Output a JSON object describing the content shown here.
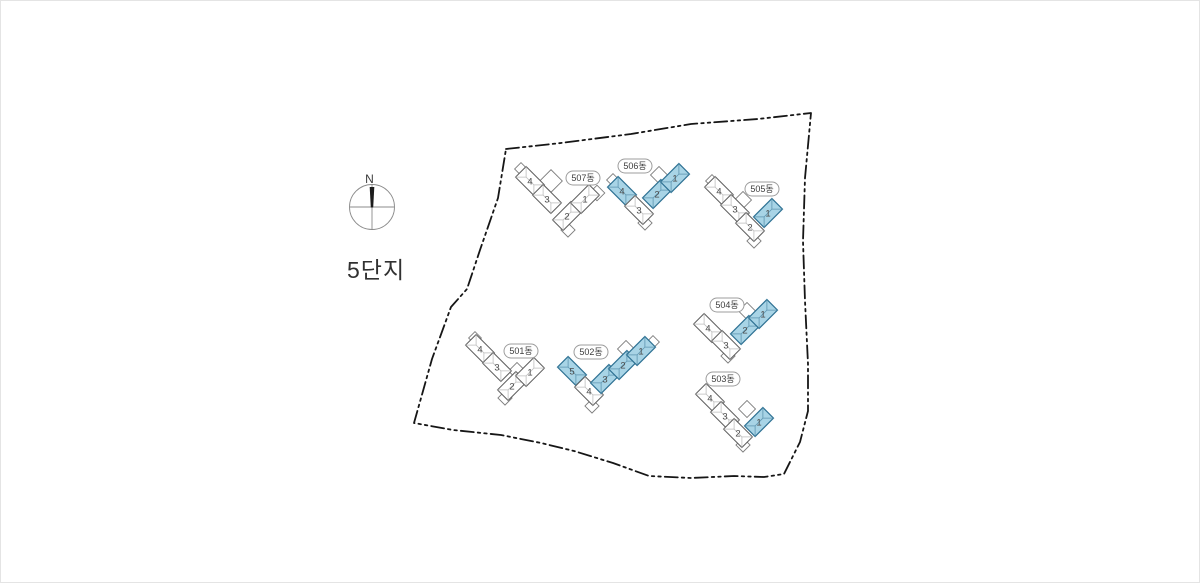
{
  "title": "5단지",
  "compass": {
    "label": "N"
  },
  "colors": {
    "selected_fill": "#A8D4E6",
    "selected_stroke": "#2E7193",
    "selected_roof_line": "#5E95B0",
    "unit_fill": "#FFFFFF",
    "unit_stroke": "#5F5F5F",
    "roof_line": "#BCBCBC",
    "boundary": "#161616",
    "title_color": "#313131"
  },
  "boundary": [
    [
      505,
      148
    ],
    [
      560,
      142
    ],
    [
      630,
      133
    ],
    [
      690,
      123
    ],
    [
      757,
      118
    ],
    [
      810,
      112
    ],
    [
      804,
      177
    ],
    [
      802,
      240
    ],
    [
      804,
      300
    ],
    [
      807,
      363
    ],
    [
      807,
      410
    ],
    [
      799,
      441
    ],
    [
      783,
      473
    ],
    [
      763,
      476
    ],
    [
      733,
      475
    ],
    [
      690,
      477
    ],
    [
      648,
      475
    ],
    [
      612,
      462
    ],
    [
      573,
      450
    ],
    [
      540,
      442
    ],
    [
      500,
      434
    ],
    [
      452,
      429
    ],
    [
      413,
      422
    ],
    [
      431,
      358
    ],
    [
      450,
      306
    ],
    [
      466,
      288
    ],
    [
      479,
      249
    ],
    [
      497,
      197
    ]
  ],
  "buildings": [
    {
      "id": "501",
      "name": "501동",
      "label": {
        "x": 520,
        "y": 350
      },
      "units": [
        {
          "no": "4",
          "cx": 479,
          "cy": 348,
          "angle": 45,
          "selected": false
        },
        {
          "no": "3",
          "cx": 496,
          "cy": 366,
          "angle": 45,
          "selected": false
        },
        {
          "no": "2",
          "cx": 511,
          "cy": 385,
          "angle": -45,
          "selected": false
        },
        {
          "no": "1",
          "cx": 529,
          "cy": 371,
          "angle": -45,
          "selected": false
        }
      ],
      "bumps": [
        [
          516,
          370,
          12
        ],
        [
          504,
          397,
          10
        ],
        [
          474,
          337,
          9
        ]
      ]
    },
    {
      "id": "502",
      "name": "502동",
      "label": {
        "x": 590,
        "y": 351
      },
      "units": [
        {
          "no": "5",
          "cx": 571,
          "cy": 370,
          "angle": 45,
          "selected": true
        },
        {
          "no": "4",
          "cx": 588,
          "cy": 390,
          "angle": 45,
          "selected": false
        },
        {
          "no": "3",
          "cx": 604,
          "cy": 378,
          "angle": -45,
          "selected": true
        },
        {
          "no": "2",
          "cx": 622,
          "cy": 364,
          "angle": -45,
          "selected": true
        },
        {
          "no": "1",
          "cx": 640,
          "cy": 350,
          "angle": -45,
          "selected": true
        }
      ],
      "bumps": [
        [
          625,
          348,
          12
        ],
        [
          591,
          405,
          10
        ],
        [
          652,
          341,
          9
        ]
      ]
    },
    {
      "id": "503",
      "name": "503동",
      "label": {
        "x": 722,
        "y": 378
      },
      "units": [
        {
          "no": "4",
          "cx": 709,
          "cy": 397,
          "angle": 45,
          "selected": false
        },
        {
          "no": "3",
          "cx": 724,
          "cy": 415,
          "angle": 45,
          "selected": false
        },
        {
          "no": "2",
          "cx": 737,
          "cy": 432,
          "angle": 45,
          "selected": false
        },
        {
          "no": "1",
          "cx": 758,
          "cy": 421,
          "angle": -45,
          "selected": true
        }
      ],
      "bumps": [
        [
          746,
          408,
          12
        ],
        [
          742,
          444,
          10
        ]
      ]
    },
    {
      "id": "504",
      "name": "504동",
      "label": {
        "x": 726,
        "y": 304
      },
      "units": [
        {
          "no": "4",
          "cx": 707,
          "cy": 327,
          "angle": 45,
          "selected": false
        },
        {
          "no": "3",
          "cx": 725,
          "cy": 344,
          "angle": 45,
          "selected": false
        },
        {
          "no": "2",
          "cx": 744,
          "cy": 329,
          "angle": -45,
          "selected": true
        },
        {
          "no": "1",
          "cx": 762,
          "cy": 313,
          "angle": -45,
          "selected": true
        }
      ],
      "bumps": [
        [
          746,
          310,
          12
        ],
        [
          727,
          355,
          10
        ]
      ]
    },
    {
      "id": "505",
      "name": "505동",
      "label": {
        "x": 761,
        "y": 188
      },
      "units": [
        {
          "no": "4",
          "cx": 718,
          "cy": 190,
          "angle": 45,
          "selected": false
        },
        {
          "no": "3",
          "cx": 734,
          "cy": 208,
          "angle": 45,
          "selected": false
        },
        {
          "no": "2",
          "cx": 749,
          "cy": 226,
          "angle": 45,
          "selected": false
        },
        {
          "no": "1",
          "cx": 767,
          "cy": 212,
          "angle": -45,
          "selected": true
        }
      ],
      "bumps": [
        [
          742,
          199,
          12
        ],
        [
          753,
          240,
          10
        ],
        [
          711,
          180,
          9
        ]
      ]
    },
    {
      "id": "506",
      "name": "506동",
      "label": {
        "x": 634,
        "y": 165
      },
      "units": [
        {
          "no": "4",
          "cx": 621,
          "cy": 190,
          "angle": 45,
          "selected": true
        },
        {
          "no": "3",
          "cx": 638,
          "cy": 209,
          "angle": 45,
          "selected": false
        },
        {
          "no": "2",
          "cx": 656,
          "cy": 193,
          "angle": -45,
          "selected": true
        },
        {
          "no": "1",
          "cx": 674,
          "cy": 177,
          "angle": -45,
          "selected": true
        }
      ],
      "bumps": [
        [
          658,
          174,
          12
        ],
        [
          644,
          222,
          10
        ],
        [
          612,
          179,
          9
        ]
      ]
    },
    {
      "id": "507",
      "name": "507동",
      "label": {
        "x": 582,
        "y": 177
      },
      "units": [
        {
          "no": "4",
          "cx": 529,
          "cy": 180,
          "angle": 45,
          "selected": false
        },
        {
          "no": "3",
          "cx": 546,
          "cy": 198,
          "angle": 45,
          "selected": false
        },
        {
          "no": "2",
          "cx": 566,
          "cy": 215,
          "angle": -45,
          "selected": false
        },
        {
          "no": "1",
          "cx": 584,
          "cy": 198,
          "angle": -45,
          "selected": false
        }
      ],
      "bumps": [
        [
          550,
          180,
          16
        ],
        [
          596,
          192,
          11
        ],
        [
          567,
          229,
          10
        ],
        [
          520,
          168,
          9
        ]
      ]
    }
  ]
}
